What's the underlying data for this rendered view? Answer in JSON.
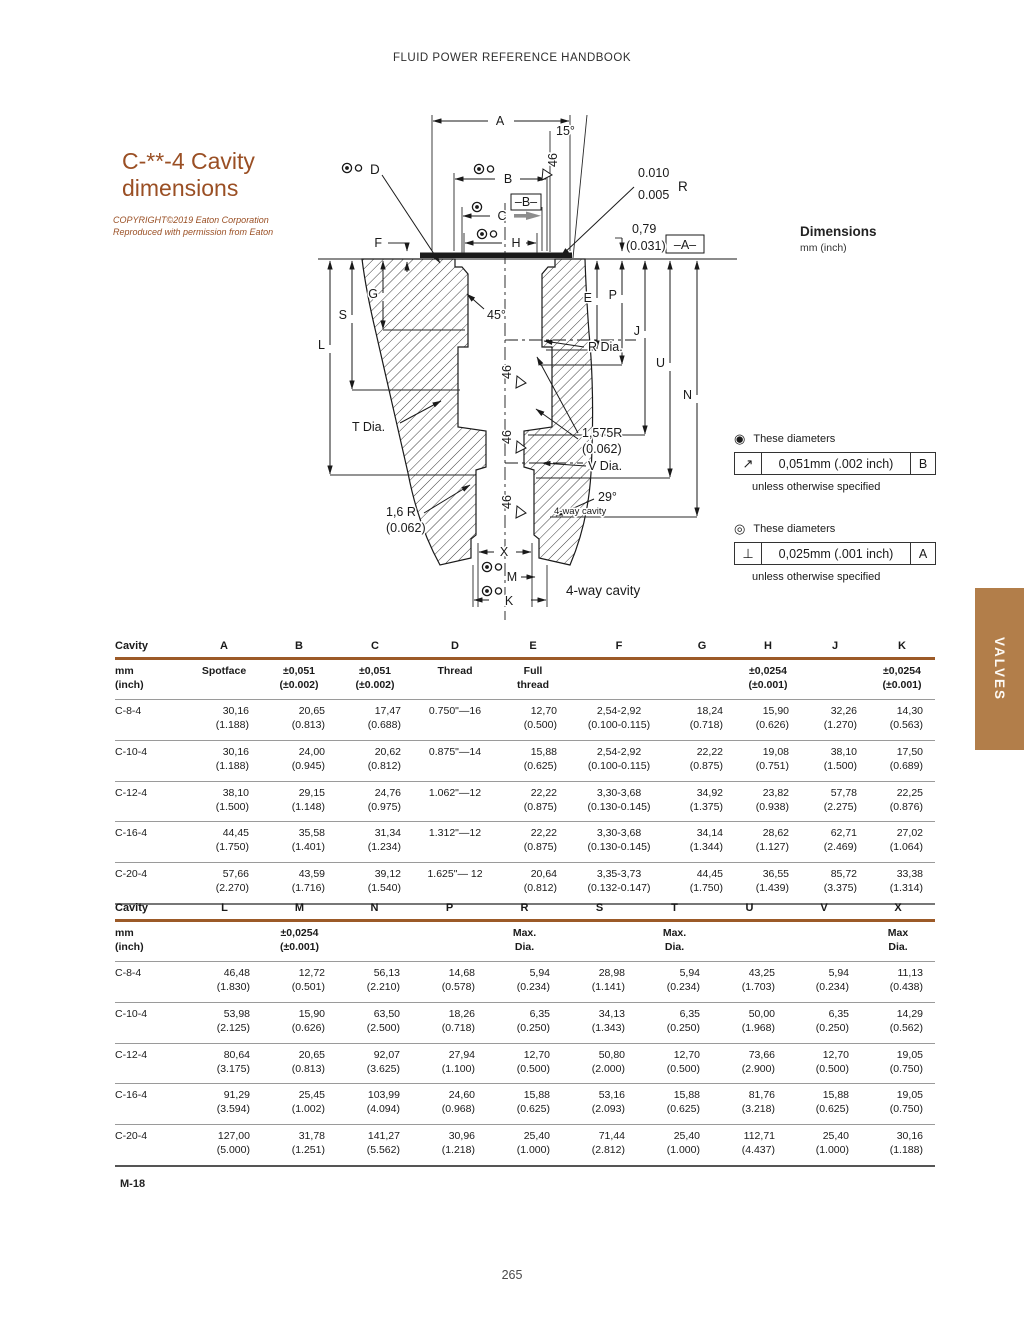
{
  "page": {
    "header": "FLUID POWER REFERENCE HANDBOOK",
    "section_code": "M-18",
    "page_number": "265"
  },
  "title": {
    "line1": "C-**-4 Cavity",
    "line2": "dimensions"
  },
  "copyright": {
    "line1": "COPYRIGHT©2019 Eaton Corporation",
    "line2": "Reproduced with permission from Eaton"
  },
  "side_tab": {
    "label": "VALVES",
    "color": "#b27e4a"
  },
  "dimensions_note": {
    "title": "Dimensions",
    "subtitle": "mm (inch)"
  },
  "tolerance_notes": [
    {
      "marker": "◉",
      "marker_name": "filled-target-circle",
      "intro": "These diameters",
      "symbol": "↗",
      "symbol_name": "circular-runout",
      "value": "0,051mm (.002 inch)",
      "datum": "B",
      "outro": "unless otherwise  specified"
    },
    {
      "marker": "◎",
      "marker_name": "open-target-circle",
      "intro": "These diameters",
      "symbol": "⊥",
      "symbol_name": "perpendicularity",
      "value": "0,025mm (.001 inch)",
      "datum": "A",
      "outro": "unless otherwise  specified"
    }
  ],
  "diagram": {
    "a": "A",
    "b": "B",
    "c": "C",
    "h": "H",
    "d": "D",
    "f": "F",
    "g": "G",
    "s": "S",
    "l": "L",
    "e": "E",
    "p": "P",
    "j": "J",
    "u": "U",
    "n": "N",
    "x": "X",
    "m": "M",
    "k": "K",
    "datum_a": "–A–",
    "datum_b": "–B–",
    "angle_15": "15°",
    "angle_45": "45°",
    "angle_29": "29°",
    "chamfer_46": "46",
    "runout_val_1": "0.010",
    "runout_val_2": "0.005",
    "runout_r": "R",
    "lip_mm": "0,79",
    "lip_inch": "(0.031)",
    "t_dia": "T Dia.",
    "r_dia": "R Dia.",
    "v_dia": "V Dia.",
    "radius_a_mm": "1,575R",
    "radius_a_inch": "(0.062)",
    "radius_b_mm": "1,6 R",
    "radius_b_inch": "(0.062)",
    "four_way_small": "4-way cavity",
    "four_way_label": "4-way cavity"
  },
  "table1": {
    "columns": [
      "Cavity",
      "A",
      "B",
      "C",
      "D",
      "E",
      "F",
      "G",
      "H",
      "J",
      "K"
    ],
    "subheaders": [
      [
        "mm",
        "(inch)"
      ],
      [
        "Spotface"
      ],
      [
        "±0,051",
        "(±0.002)"
      ],
      [
        "±0,051",
        "(±0.002)"
      ],
      [
        "Thread"
      ],
      [
        "Full",
        "thread"
      ],
      [
        ""
      ],
      [
        ""
      ],
      [
        "±0,0254",
        "(±0.001)"
      ],
      [
        ""
      ],
      [
        "±0,0254",
        "(±0.001)"
      ]
    ],
    "align": [
      "l",
      "r",
      "r",
      "r",
      "c",
      "r",
      "c",
      "r",
      "r",
      "r",
      "r"
    ],
    "widths": [
      72,
      74,
      76,
      76,
      84,
      72,
      100,
      66,
      66,
      68,
      66
    ],
    "rows": [
      {
        "cavity": "C-8-4",
        "cells": [
          [
            "30,16",
            "(1.188)"
          ],
          [
            "20,65",
            "(0.813)"
          ],
          [
            "17,47",
            "(0.688)"
          ],
          [
            "0.750\"—16"
          ],
          [
            "12,70",
            "(0.500)"
          ],
          [
            "2,54-2,92",
            "(0.100-0.115)"
          ],
          [
            "18,24",
            "(0.718)"
          ],
          [
            "15,90",
            "(0.626)"
          ],
          [
            "32,26",
            "(1.270)"
          ],
          [
            "14,30",
            "(0.563)"
          ]
        ]
      },
      {
        "cavity": "C-10-4",
        "cells": [
          [
            "30,16",
            "(1.188)"
          ],
          [
            "24,00",
            "(0.945)"
          ],
          [
            "20,62",
            "(0.812)"
          ],
          [
            "0.875\"—14"
          ],
          [
            "15,88",
            "(0.625)"
          ],
          [
            "2,54-2,92",
            "(0.100-0.115)"
          ],
          [
            "22,22",
            "(0.875)"
          ],
          [
            "19,08",
            "(0.751)"
          ],
          [
            "38,10",
            "(1.500)"
          ],
          [
            "17,50",
            "(0.689)"
          ]
        ]
      },
      {
        "cavity": "C-12-4",
        "cells": [
          [
            "38,10",
            "(1.500)"
          ],
          [
            "29,15",
            "(1.148)"
          ],
          [
            "24,76",
            "(0.975)"
          ],
          [
            "1.062\"—12"
          ],
          [
            "22,22",
            "(0.875)"
          ],
          [
            "3,30-3,68",
            "(0.130-0.145)"
          ],
          [
            "34,92",
            "(1.375)"
          ],
          [
            "23,82",
            "(0.938)"
          ],
          [
            "57,78",
            "(2.275)"
          ],
          [
            "22,25",
            "(0.876)"
          ]
        ]
      },
      {
        "cavity": "C-16-4",
        "cells": [
          [
            "44,45",
            "(1.750)"
          ],
          [
            "35,58",
            "(1.401)"
          ],
          [
            "31,34",
            "(1.234)"
          ],
          [
            "1.312\"—12"
          ],
          [
            "22,22",
            "(0.875)"
          ],
          [
            "3,30-3,68",
            "(0.130-0.145)"
          ],
          [
            "34,14",
            "(1.344)"
          ],
          [
            "28,62",
            "(1.127)"
          ],
          [
            "62,71",
            "(2.469)"
          ],
          [
            "27,02",
            "(1.064)"
          ]
        ]
      },
      {
        "cavity": "C-20-4",
        "cells": [
          [
            "57,66",
            "(2.270)"
          ],
          [
            "43,59",
            "(1.716)"
          ],
          [
            "39,12",
            "(1.540)"
          ],
          [
            "1.625\"— 12"
          ],
          [
            "20,64",
            "(0.812)"
          ],
          [
            "3,35-3,73",
            "(0.132-0.147)"
          ],
          [
            "44,45",
            "(1.750)"
          ],
          [
            "36,55",
            "(1.439)"
          ],
          [
            "85,72",
            "(3.375)"
          ],
          [
            "33,38",
            "(1.314)"
          ]
        ]
      }
    ]
  },
  "table2": {
    "columns": [
      "Cavity",
      "L",
      "M",
      "N",
      "P",
      "R",
      "S",
      "T",
      "U",
      "V",
      "X"
    ],
    "subheaders": [
      [
        "mm",
        "(inch)"
      ],
      [
        ""
      ],
      [
        "±0,0254",
        "(±0.001)"
      ],
      [
        ""
      ],
      [
        ""
      ],
      [
        "Max.",
        "Dia."
      ],
      [
        ""
      ],
      [
        "Max.",
        "Dia."
      ],
      [
        ""
      ],
      [
        ""
      ],
      [
        "Max",
        "Dia."
      ]
    ],
    "align": [
      "l",
      "r",
      "r",
      "r",
      "r",
      "r",
      "r",
      "r",
      "r",
      "r",
      "r"
    ],
    "widths": [
      72,
      75,
      75,
      75,
      75,
      75,
      75,
      75,
      75,
      74,
      74
    ],
    "rows": [
      {
        "cavity": "C-8-4",
        "cells": [
          [
            "46,48",
            "(1.830)"
          ],
          [
            "12,72",
            "(0.501)"
          ],
          [
            "56,13",
            "(2.210)"
          ],
          [
            "14,68",
            "(0.578)"
          ],
          [
            "5,94",
            "(0.234)"
          ],
          [
            "28,98",
            "(1.141)"
          ],
          [
            "5,94",
            "(0.234)"
          ],
          [
            "43,25",
            "(1.703)"
          ],
          [
            "5,94",
            "(0.234)"
          ],
          [
            "11,13",
            "(0.438)"
          ]
        ]
      },
      {
        "cavity": "C-10-4",
        "cells": [
          [
            "53,98",
            "(2.125)"
          ],
          [
            "15,90",
            "(0.626)"
          ],
          [
            "63,50",
            "(2.500)"
          ],
          [
            "18,26",
            "(0.718)"
          ],
          [
            "6,35",
            "(0.250)"
          ],
          [
            "34,13",
            "(1.343)"
          ],
          [
            "6,35",
            "(0.250)"
          ],
          [
            "50,00",
            "(1.968)"
          ],
          [
            "6,35",
            "(0.250)"
          ],
          [
            "14,29",
            "(0.562)"
          ]
        ]
      },
      {
        "cavity": "C-12-4",
        "cells": [
          [
            "80,64",
            "(3.175)"
          ],
          [
            "20,65",
            "(0.813)"
          ],
          [
            "92,07",
            "(3.625)"
          ],
          [
            "27,94",
            "(1.100)"
          ],
          [
            "12,70",
            "(0.500)"
          ],
          [
            "50,80",
            "(2.000)"
          ],
          [
            "12,70",
            "(0.500)"
          ],
          [
            "73,66",
            "(2.900)"
          ],
          [
            "12,70",
            "(0.500)"
          ],
          [
            "19,05",
            "(0.750)"
          ]
        ]
      },
      {
        "cavity": "C-16-4",
        "cells": [
          [
            "91,29",
            "(3.594)"
          ],
          [
            "25,45",
            "(1.002)"
          ],
          [
            "103,99",
            "(4.094)"
          ],
          [
            "24,60",
            "(0.968)"
          ],
          [
            "15,88",
            "(0.625)"
          ],
          [
            "53,16",
            "(2.093)"
          ],
          [
            "15,88",
            "(0.625)"
          ],
          [
            "81,76",
            "(3.218)"
          ],
          [
            "15,88",
            "(0.625)"
          ],
          [
            "19,05",
            "(0.750)"
          ]
        ]
      },
      {
        "cavity": "C-20-4",
        "cells": [
          [
            "127,00",
            "(5.000)"
          ],
          [
            "31,78",
            "(1.251)"
          ],
          [
            "141,27",
            "(5.562)"
          ],
          [
            "30,96",
            "(1.218)"
          ],
          [
            "25,40",
            "(1.000)"
          ],
          [
            "71,44",
            "(2.812)"
          ],
          [
            "25,40",
            "(1.000)"
          ],
          [
            "112,71",
            "(4.437)"
          ],
          [
            "25,40",
            "(1.000)"
          ],
          [
            "30,16",
            "(1.188)"
          ]
        ]
      }
    ]
  }
}
